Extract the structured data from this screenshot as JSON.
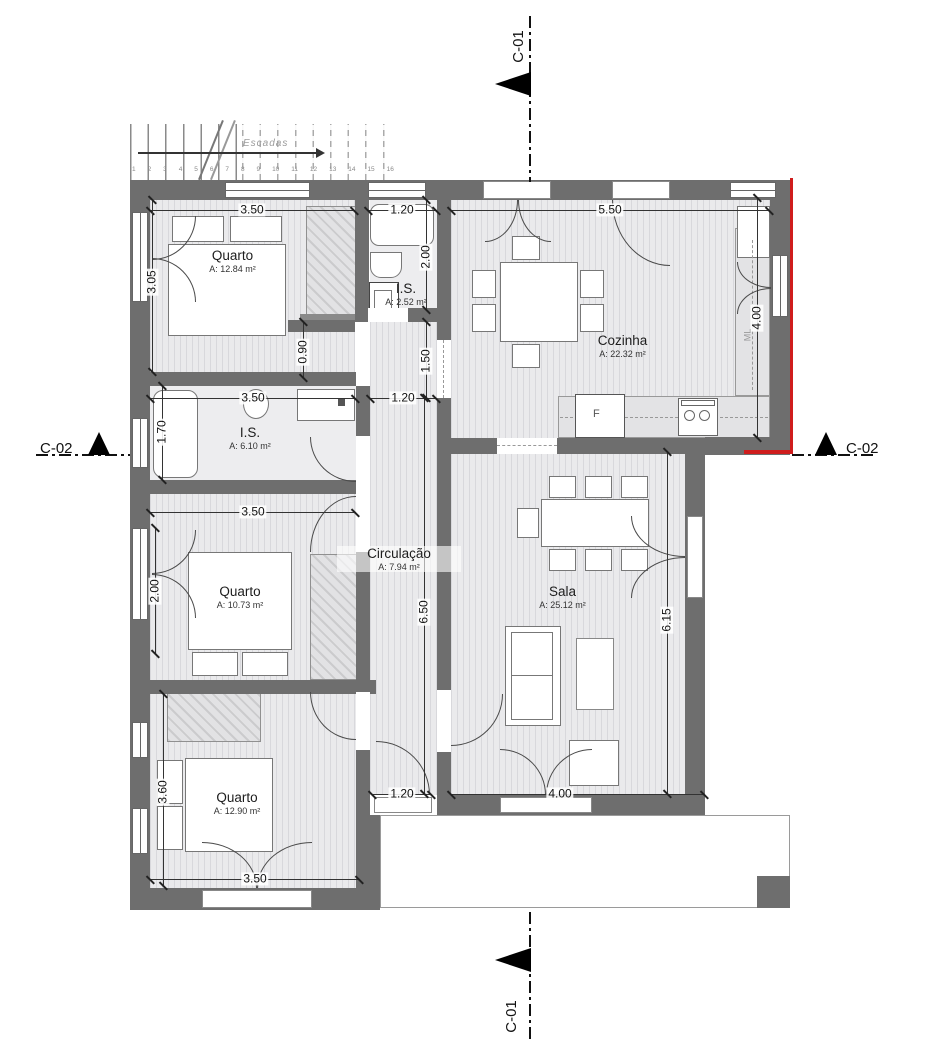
{
  "sections": {
    "c01": "C-01",
    "c02": "C-02"
  },
  "stairs": {
    "label": "Escadas",
    "treads": [
      "1",
      "2",
      "3",
      "4",
      "5",
      "6",
      "7",
      "8",
      "9",
      "10",
      "11",
      "12",
      "13",
      "14",
      "15",
      "16"
    ]
  },
  "rooms": {
    "quarto1": {
      "name": "Quarto",
      "area": "A: 12.84 m²"
    },
    "is1": {
      "name": "I.S.",
      "area": "A: 2.52 m²"
    },
    "cozinha": {
      "name": "Cozinha",
      "area": "A: 22.32 m²"
    },
    "is2": {
      "name": "I.S.",
      "area": "A: 6.10 m²"
    },
    "quarto2": {
      "name": "Quarto",
      "area": "A: 10.73 m²"
    },
    "circulacao": {
      "name": "Circulação",
      "area": "A: 7.94 m²"
    },
    "sala": {
      "name": "Sala",
      "area": "A: 25.12 m²"
    },
    "quarto3": {
      "name": "Quarto",
      "area": "A: 12.90 m²"
    }
  },
  "dims": {
    "q1_top": "3.50",
    "is1_top": "1.20",
    "coz_top": "5.50",
    "q1_left": "3.05",
    "is1_right": "2.00",
    "coz_right": "4.00",
    "wardrobe": "0.90",
    "passage": "1.50",
    "is2_top": "3.50",
    "hall_top": "1.20",
    "is2_left": "1.70",
    "q2_top": "3.50",
    "q2_left": "2.00",
    "corridor": "6.50",
    "sala_right": "6.15",
    "q3_left": "3.60",
    "hall_bottom": "1.20",
    "sala_bottom": "4.00",
    "q3_bottom": "3.50"
  },
  "labels": {
    "fridge": "F",
    "washer": "ML"
  },
  "colors": {
    "wall": "#6e6e6e",
    "accent": "#cf1d1d",
    "floor": "#e9e9ec",
    "line": "#2e2e2e"
  }
}
